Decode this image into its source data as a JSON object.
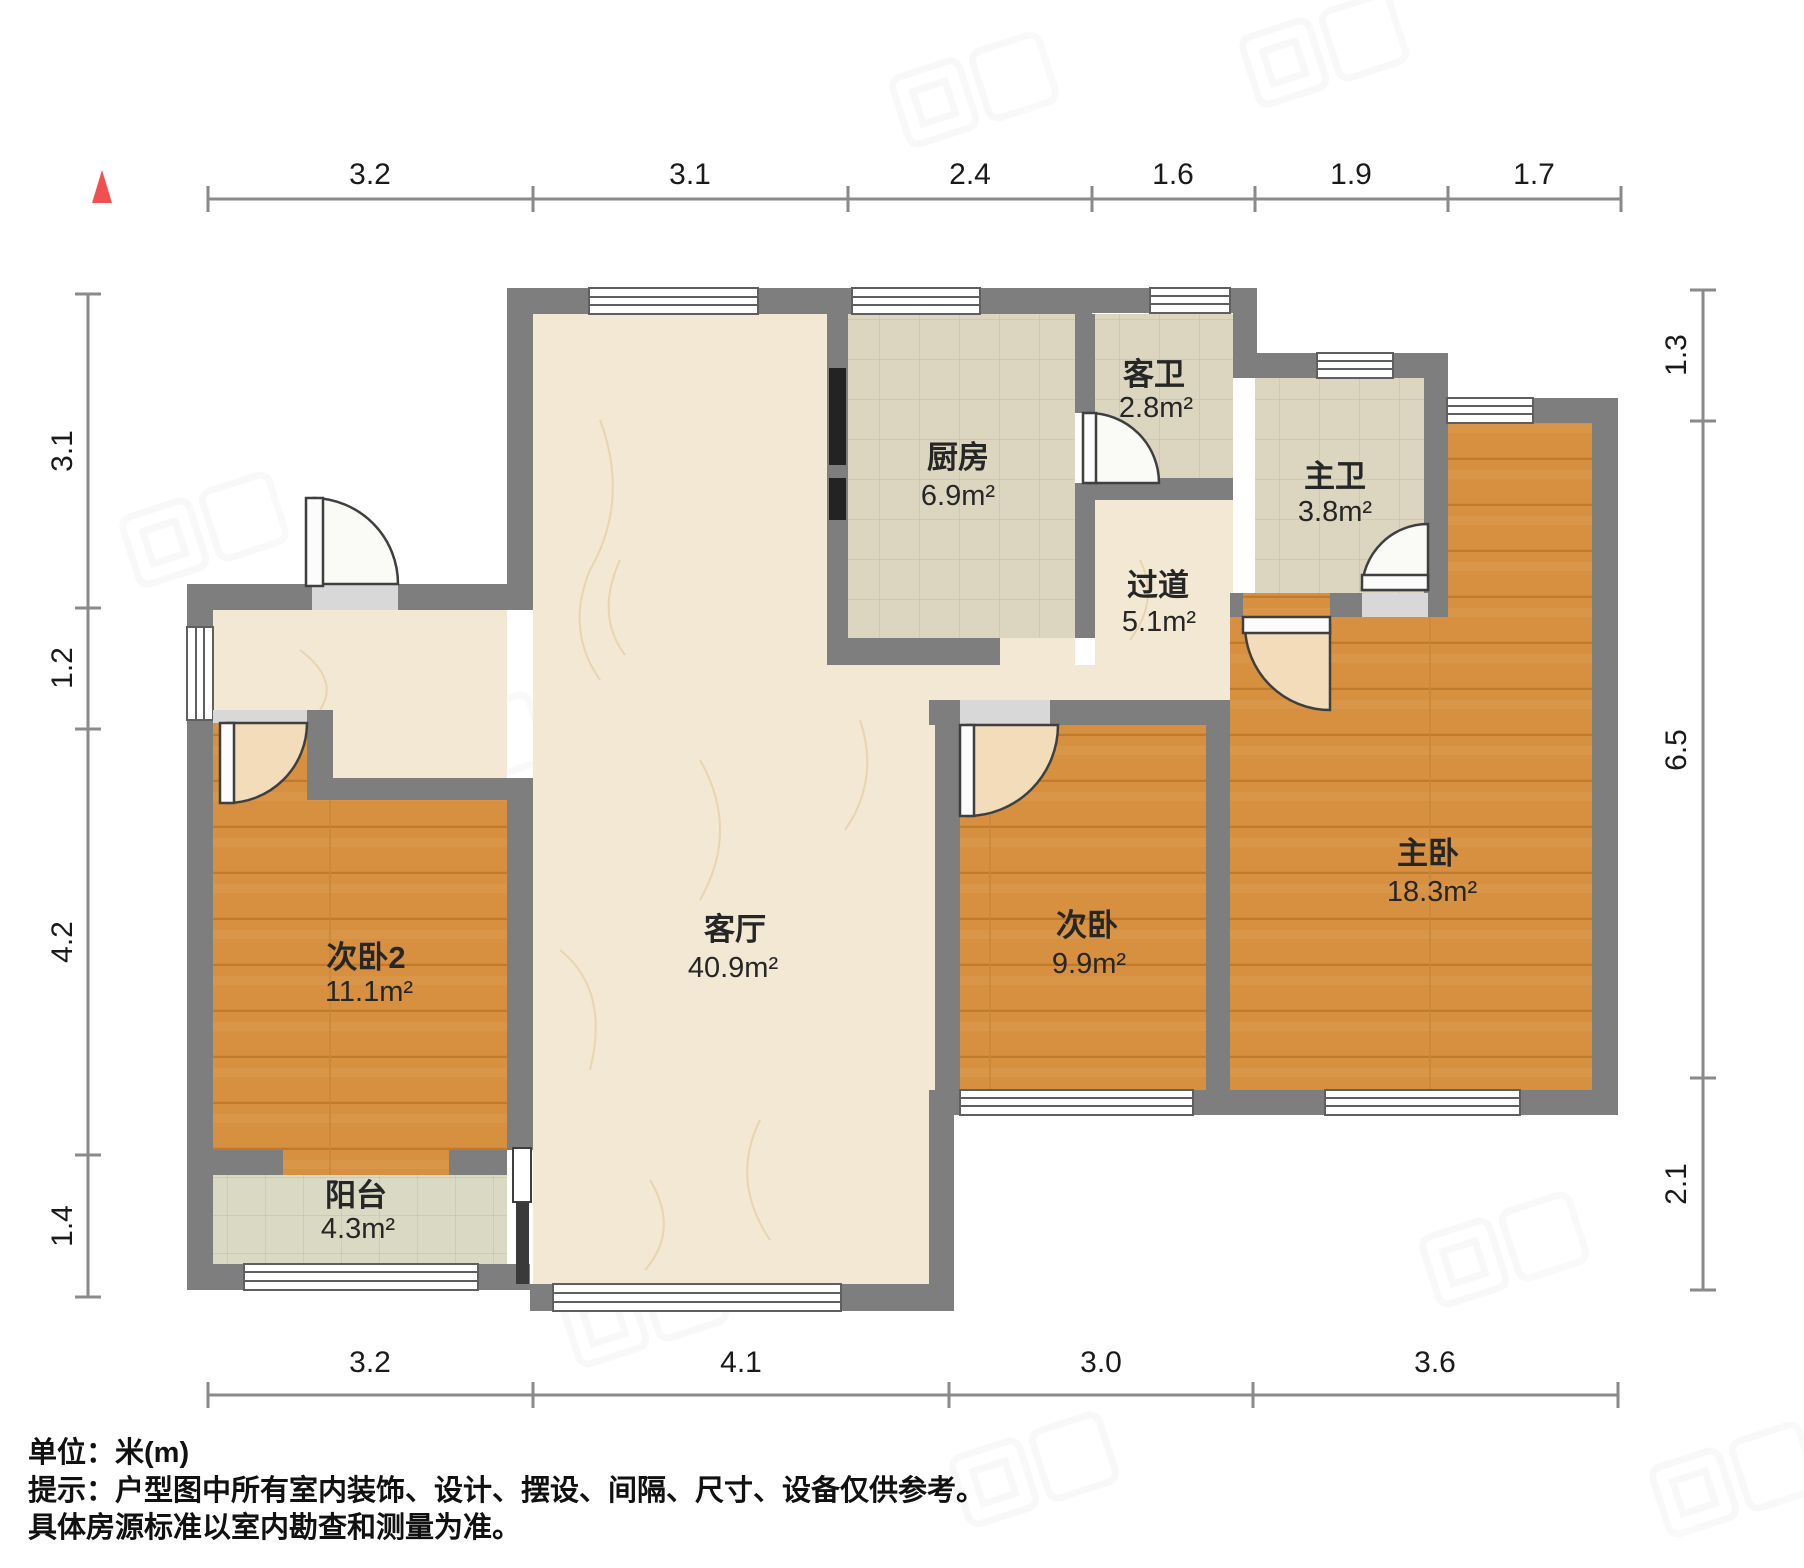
{
  "footer": {
    "unit": "单位：米(m)",
    "notice1": "提示：户型图中所有室内装饰、设计、摆设、间隔、尺寸、设备仅供参考。",
    "notice2": "具体房源标准以室内勘查和测量为准。"
  },
  "rooms": [
    {
      "id": "kitchen",
      "name": "厨房",
      "area": "6.9m²"
    },
    {
      "id": "guest-bathroom",
      "name": "客卫",
      "area": "2.8m²"
    },
    {
      "id": "master-bathroom",
      "name": "主卫",
      "area": "3.8m²"
    },
    {
      "id": "hallway",
      "name": "过道",
      "area": "5.1m²"
    },
    {
      "id": "living-room",
      "name": "客厅",
      "area": "40.9m²"
    },
    {
      "id": "bedroom-2",
      "name": "次卧2",
      "area": "11.1m²"
    },
    {
      "id": "balcony",
      "name": "阳台",
      "area": "4.3m²"
    },
    {
      "id": "bedroom",
      "name": "次卧",
      "area": "9.9m²"
    },
    {
      "id": "master-bedroom",
      "name": "主卧",
      "area": "18.3m²"
    }
  ],
  "dimensions": {
    "top": [
      "3.2",
      "3.1",
      "2.4",
      "1.6",
      "1.9",
      "1.7"
    ],
    "bottom": [
      "3.2",
      "4.1",
      "3.0",
      "3.6"
    ],
    "left": [
      "3.1",
      "1.2",
      "4.2",
      "1.4"
    ],
    "right": [
      "1.3",
      "6.5",
      "2.1"
    ]
  },
  "colors": {
    "wall": "#7e7e7e",
    "wood_floor": "#d69040",
    "tile_floor": "#dcd6c0",
    "marble_floor": "#f2e8d3",
    "balcony_floor": "#dadac4",
    "compass_north": "#f25050",
    "dimension_text": "#1a1a1a"
  }
}
